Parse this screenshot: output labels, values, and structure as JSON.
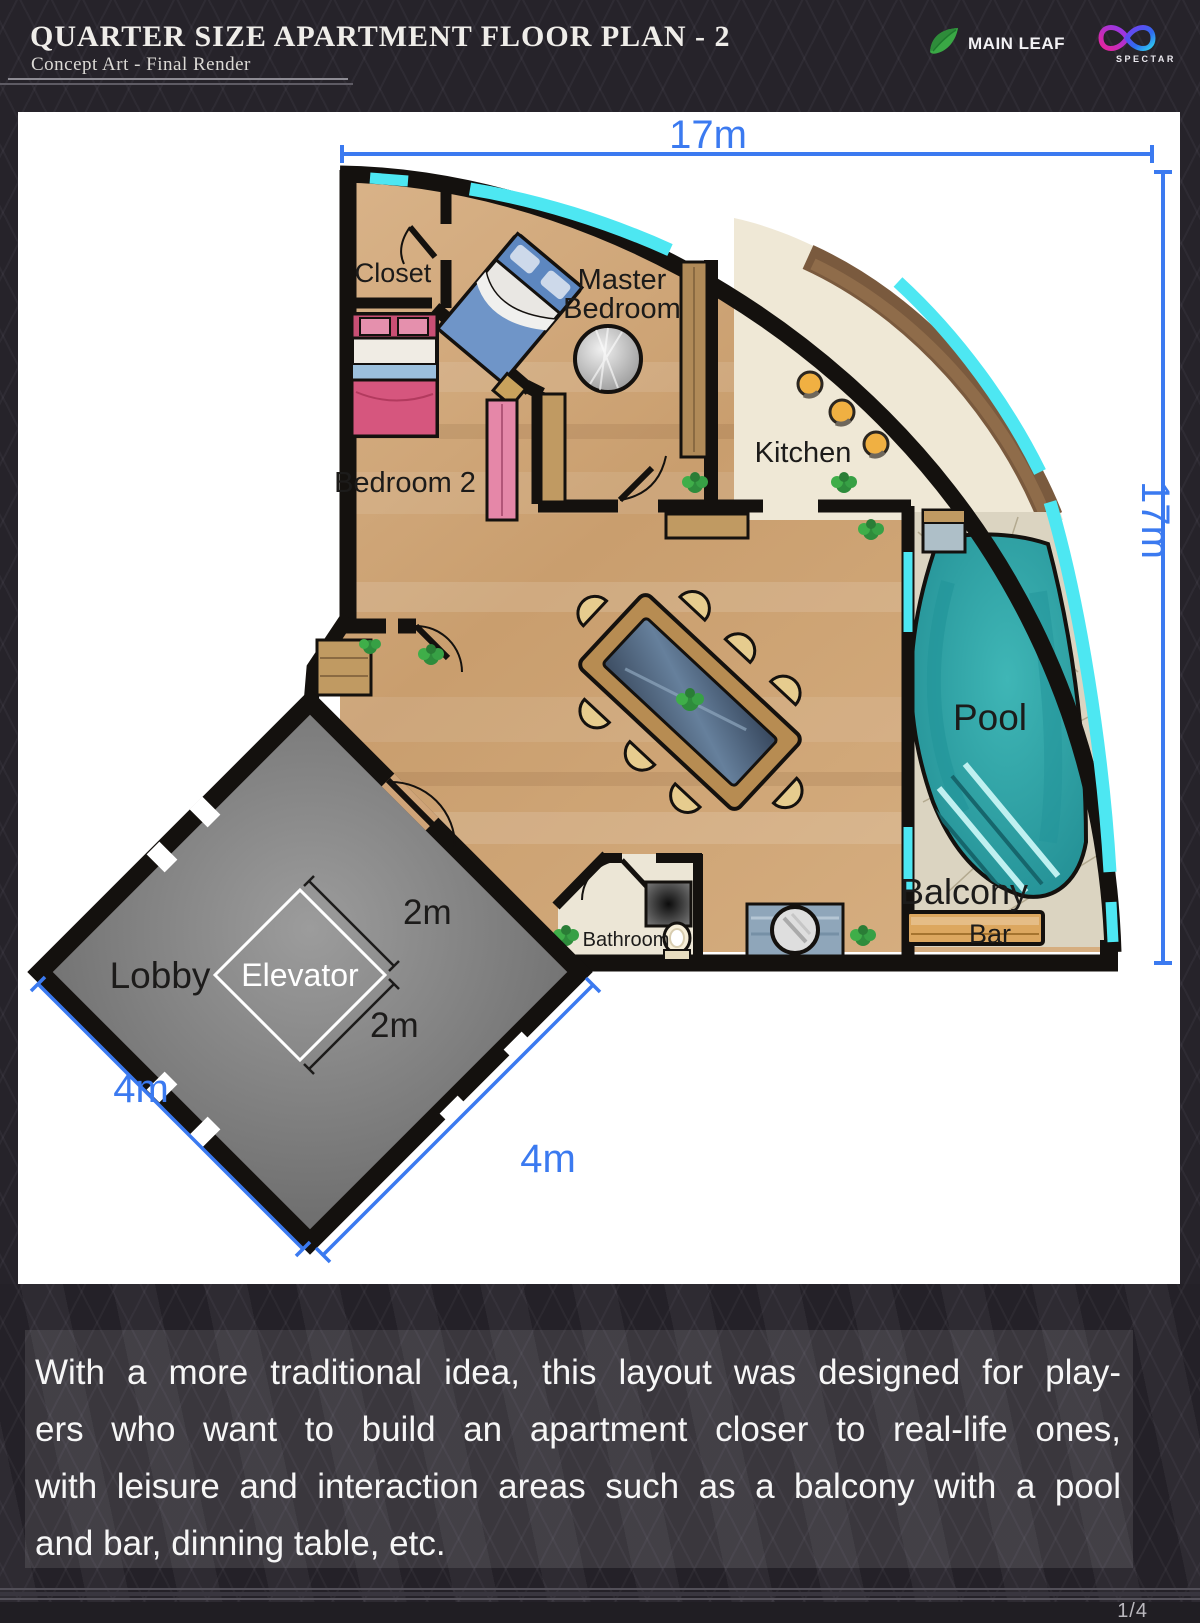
{
  "header": {
    "title": "QUARTER SIZE APARTMENT FLOOR PLAN - 2",
    "subtitle": "Concept Art - Final Render",
    "brand_main_leaf": "MAIN LEAF",
    "brand_spectar": "SPECTAR"
  },
  "floor_plan": {
    "rooms": {
      "closet": "Closet",
      "master_bedroom_line1": "Master",
      "master_bedroom_line2": "Bedroom",
      "bedroom2": "Bedroom 2",
      "kitchen": "Kitchen",
      "pool": "Pool",
      "balcony": "Balcony",
      "bar": "Bar",
      "bathroom": "Bathroom",
      "lobby": "Lobby",
      "elevator": "Elevator"
    },
    "dimensions": {
      "plan_width": "17m",
      "plan_height": "17m",
      "elevator_width": "2m",
      "elevator_depth": "2m",
      "lobby_side_left": "4m",
      "lobby_side_right": "4m"
    },
    "colors": {
      "dimension_blue": "#3b7af0",
      "window_cyan": "#4de7f2",
      "pool_teal": "#2ba6ab",
      "wall_black": "#14110e",
      "wood_floor": "#cfa478"
    }
  },
  "description": {
    "lines": [
      "With a more traditional idea, this layout was designed for play-",
      "ers who want to build an apartment closer to real-life ones,",
      "with leisure and interaction areas such as a balcony with a pool",
      "and bar, dinning table, etc."
    ]
  },
  "footer": {
    "page_indicator": "1/4"
  }
}
